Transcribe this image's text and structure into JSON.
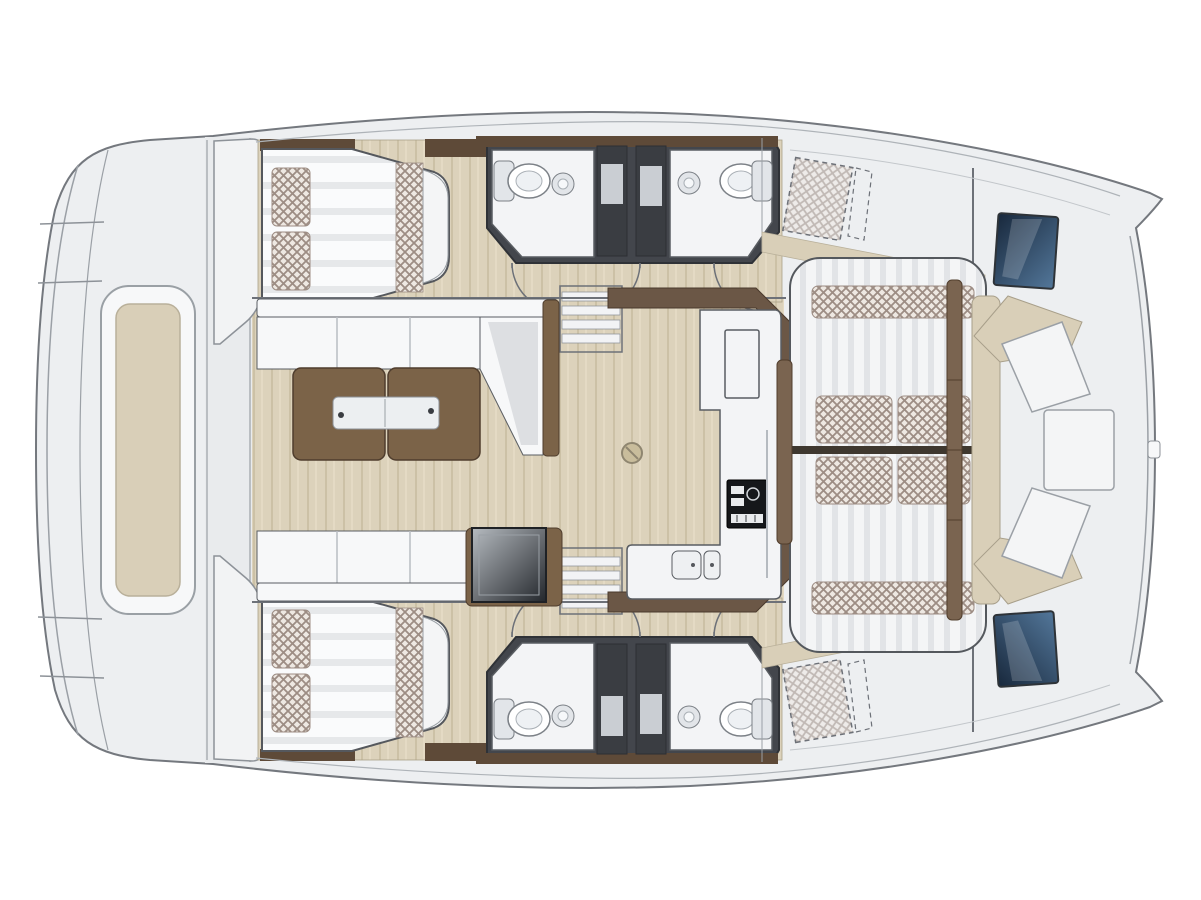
{
  "document": {
    "background": "#ffffff"
  },
  "palette": {
    "hull_fill": "#edeff1",
    "hull_stroke": "#74787e",
    "deck_line": "#9ba0a6",
    "floor_white": "#f3f4f6",
    "wood_base": "#dcd2bb",
    "wood_grain": "#ccc1a6",
    "wood_grain_light": "#e6ddc8",
    "beige_trim": "#d9cfb8",
    "beige_trim_edge": "#b3a98f",
    "sofa_white": "#f7f8f9",
    "sofa_seam": "#b9bdc2",
    "sofa_shadow": "#d8dbde",
    "table_brown": "#7b6348",
    "table_brown_edge": "#4f3d2d",
    "trim_brown_dark": "#5e4a38",
    "rail_brown": "#7a6450",
    "bath_frame": "#43464c",
    "stall_dark": "#3a3d42",
    "stall_panel": "#caced3",
    "fixture_white": "#ffffff",
    "fixture_fill": "#e2e5e9",
    "fixture_stroke": "#7c8187",
    "stove_dark": "#15171a",
    "sink_fill": "#eef0f2",
    "navy_deep": "#18283c",
    "navy_light": "#53779a",
    "crosshatch_base": "#eee8e2",
    "crosshatch_line": "#9d8d84",
    "mattress_base": "#fafbfc",
    "mattress_stripe": "#e6e8ea",
    "bench_base": "#f4f5f6",
    "bench_stripe": "#e2e4e7",
    "dark_table_light": "#b6bbc0",
    "dark_table_dark": "#23272c",
    "outline_dark": "#55585d",
    "divider_dark": "#3f382f",
    "metal_strip": "#eceff1"
  }
}
